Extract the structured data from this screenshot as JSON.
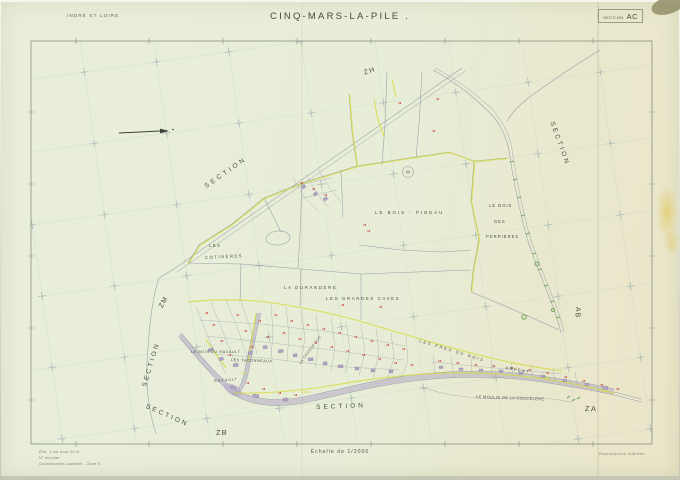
{
  "header": {
    "department": "INDRE ET LOIRE",
    "title": "CINQ-MARS-LA-PILE .",
    "section_word": "SECTION",
    "section_code": "AC"
  },
  "map": {
    "labels": [
      {
        "id": "section-nw",
        "text": "SECTION"
      },
      {
        "id": "zone-zh",
        "text": "ZH"
      },
      {
        "id": "section-east",
        "text": "SECTION"
      },
      {
        "id": "zone-ab",
        "text": "AB"
      },
      {
        "id": "zone-za",
        "text": "ZA"
      },
      {
        "id": "section-west",
        "text": "SECTION"
      },
      {
        "id": "zone-zm",
        "text": "ZM"
      },
      {
        "id": "section-sw",
        "text": "SECTION"
      },
      {
        "id": "zone-zb",
        "text": "ZB"
      },
      {
        "id": "section-south",
        "text": "SECTION"
      },
      {
        "id": "les",
        "text": "LES"
      },
      {
        "id": "cotineres",
        "text": "COTINÈRES"
      },
      {
        "id": "la-durandere",
        "text": "LA DURANDÈRE"
      },
      {
        "id": "les-grandes-caves",
        "text": "LES GRANDES CAVES"
      },
      {
        "id": "le-bois-pineau",
        "text": "LE BOIS - PINEAU"
      },
      {
        "id": "le-bois",
        "text": "LE BOIS"
      },
      {
        "id": "des",
        "text": "DES"
      },
      {
        "id": "perrieres",
        "text": "PERRIÈRES"
      },
      {
        "id": "le-bois-du-racault",
        "text": "LE BOIS DU RACAULT"
      },
      {
        "id": "les-taconneaux",
        "text": "LES TACONNEAUX"
      },
      {
        "id": "racault",
        "text": "RACAULT"
      },
      {
        "id": "la-grande-rue",
        "text": "LA GRANDE RUE"
      },
      {
        "id": "les-pres-du-bois",
        "text": "LES PRES DU BOIS"
      },
      {
        "id": "arpent",
        "text": "ARPENT"
      },
      {
        "id": "le-moulin",
        "text": "LE MOULIN DE LA DOUCELÈRE"
      }
    ]
  },
  "footer": {
    "scale": "Échelle de 1/2000",
    "notes_left": [
      "Éch. 1 cm pour 20 m",
      "N° du plan",
      "Coordonnées Lambert - Zone II"
    ],
    "note_right": "Reproduction interdite"
  },
  "colors": {
    "sheet": "#e9eeda",
    "line_gray": "#8d95a2",
    "boundary_yellow": "#d6dc3f",
    "vegetation_green": "#79a863",
    "number_red": "#c33d2f",
    "building_purple": "#b0a4c2",
    "ink": "#3f4439"
  }
}
